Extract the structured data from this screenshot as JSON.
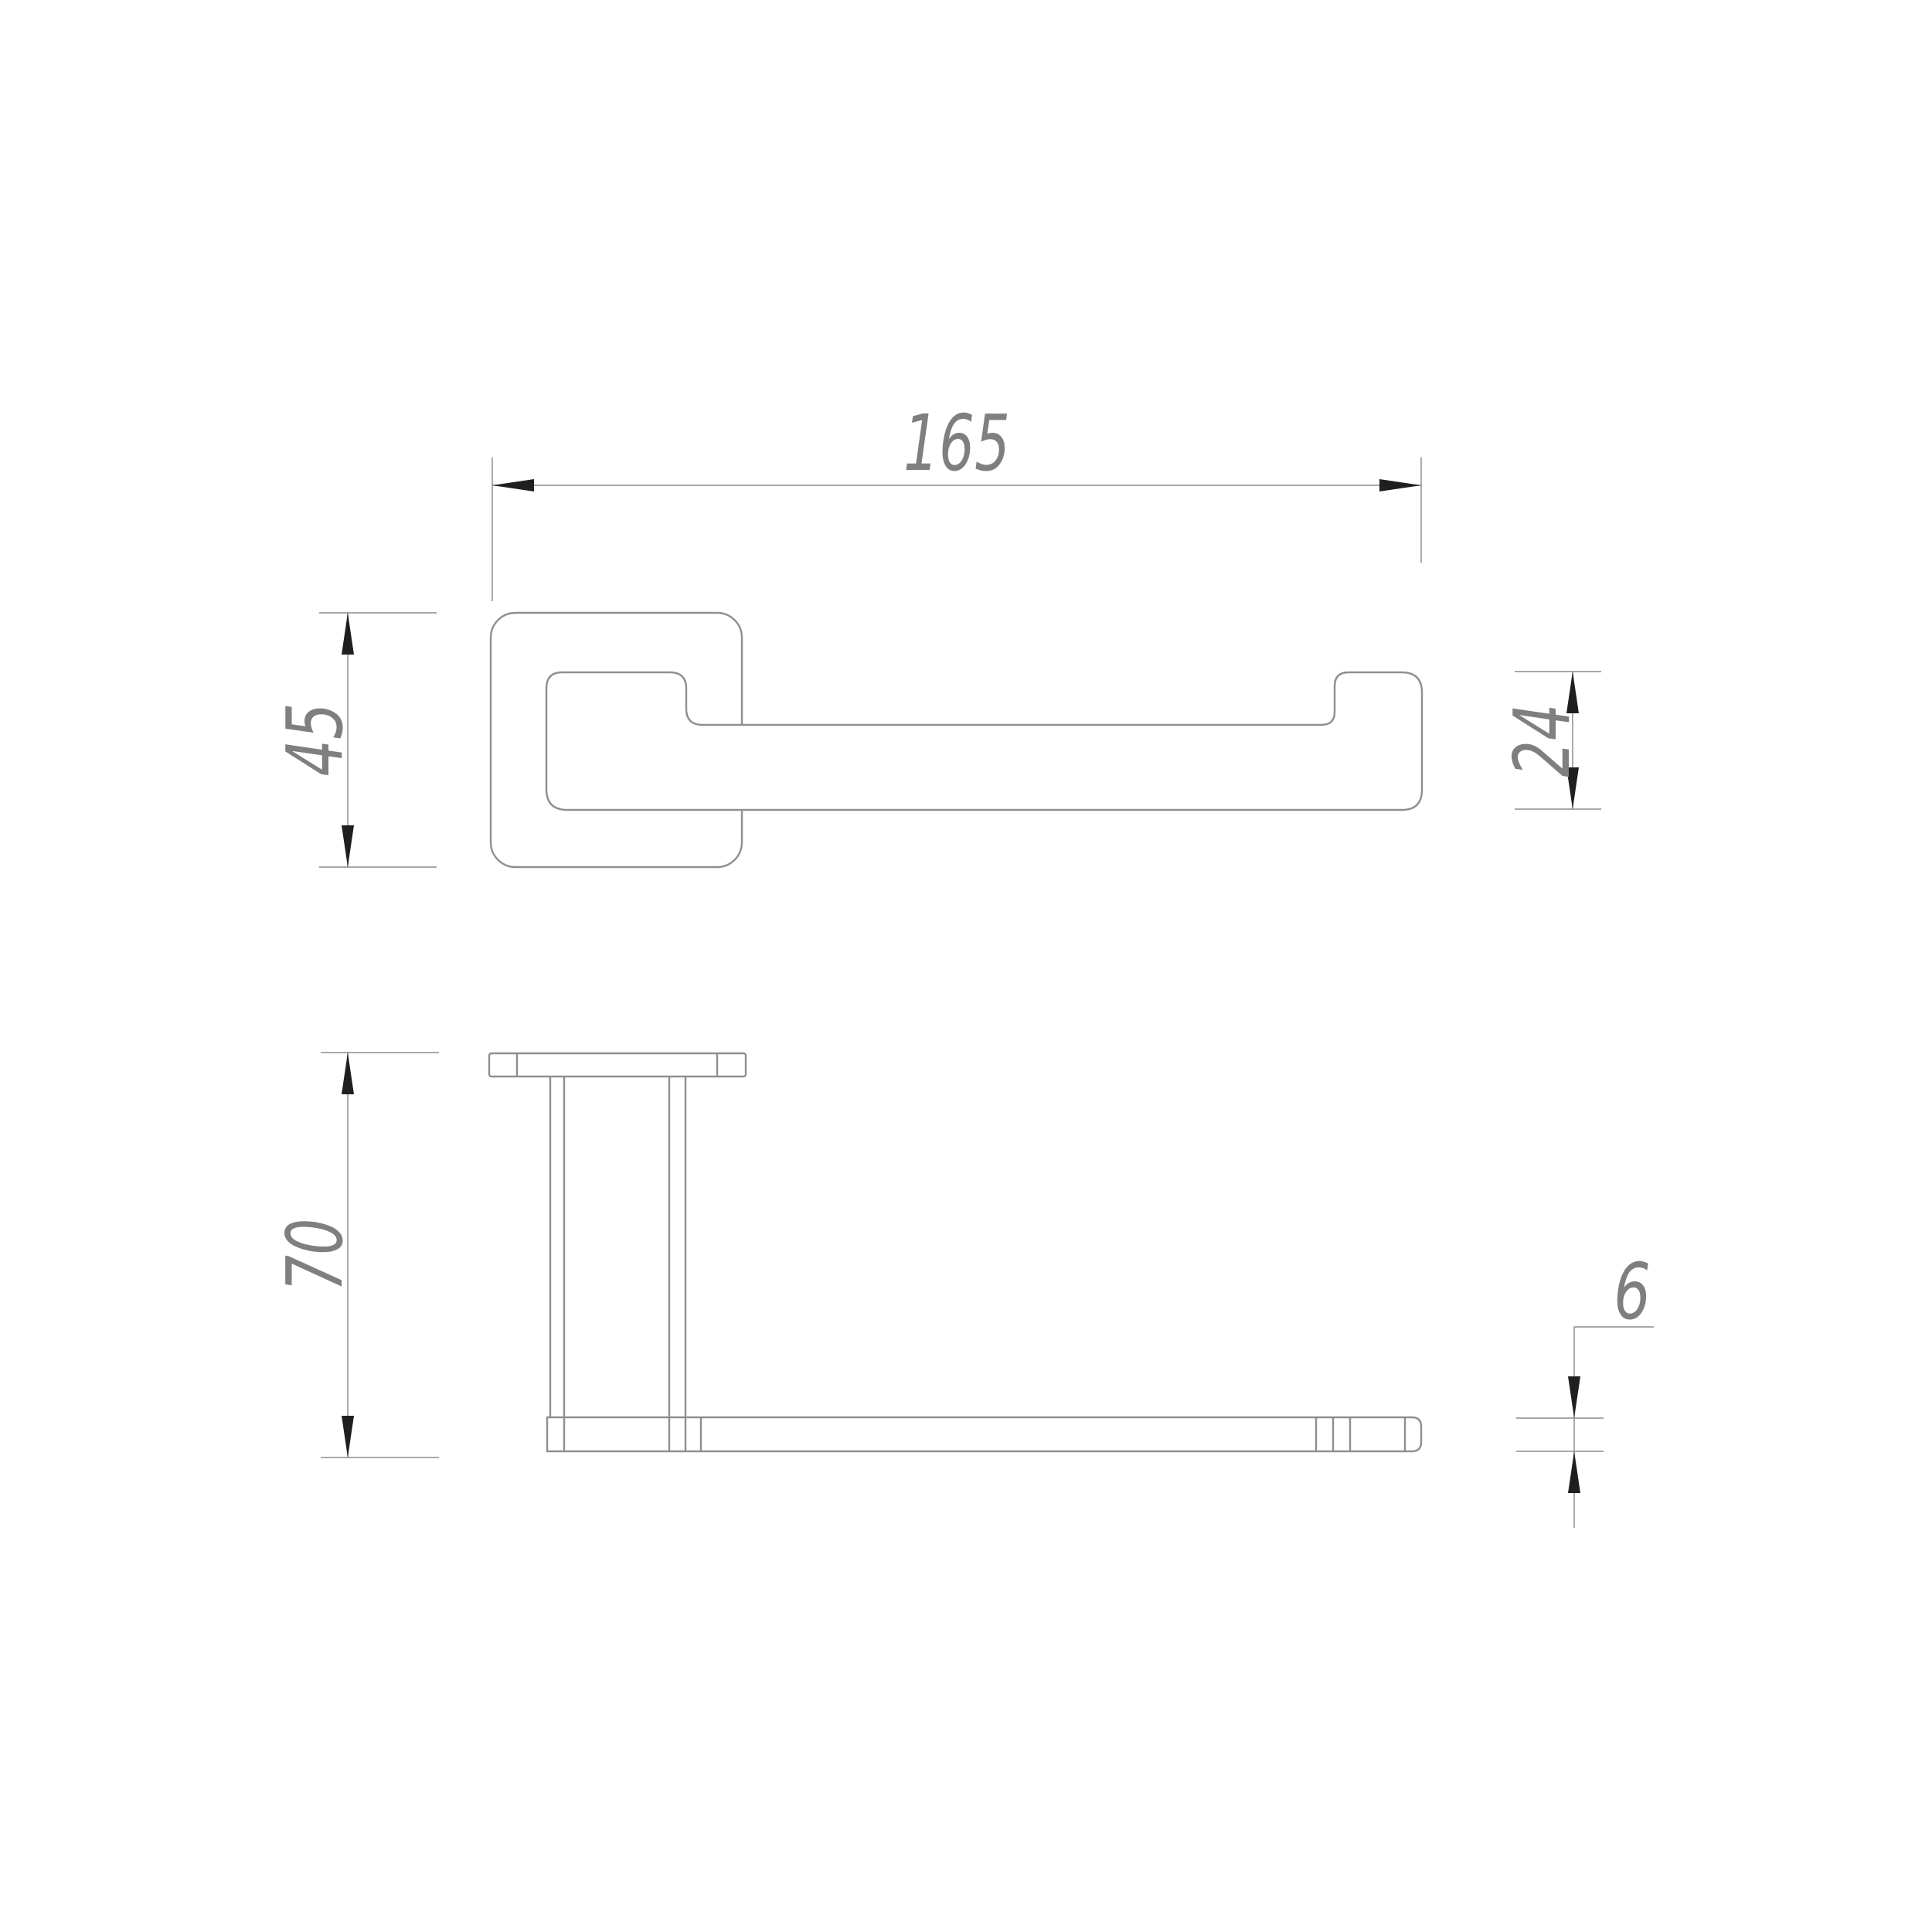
{
  "drawing": {
    "type": "technical-dimension-drawing",
    "subject": "wall-mounted holder / towel bar, two orthographic views",
    "units": "mm",
    "colors": {
      "bg": "#ffffff",
      "line": "#8f8f8f",
      "dim": "#9c9c9c",
      "arrow": "#1f1f1f",
      "txt": "#7f7f7f"
    },
    "views": [
      {
        "id": "top-view",
        "description": "plan view: rounded square wall plate with arm extending right, upturned rounded end"
      },
      {
        "id": "front-view",
        "description": "front view: wall plate edge-on at top, twin-line post dropping to a long horizontal bottom bar"
      }
    ],
    "dimensions": {
      "total_length": {
        "value": "165",
        "applies_to": "overall length of arm from plate left edge to arm right end"
      },
      "plate_size": {
        "value": "45",
        "applies_to": "wall plate height (top view)"
      },
      "arm_end_height": {
        "value": "24",
        "applies_to": "height of upturned right end of arm (top view)"
      },
      "drop_height": {
        "value": "70",
        "applies_to": "overall height from plate top to bottom bar (front view)"
      },
      "bar_thickness": {
        "value": "6",
        "applies_to": "thickness of bottom bar (front view)"
      }
    }
  }
}
